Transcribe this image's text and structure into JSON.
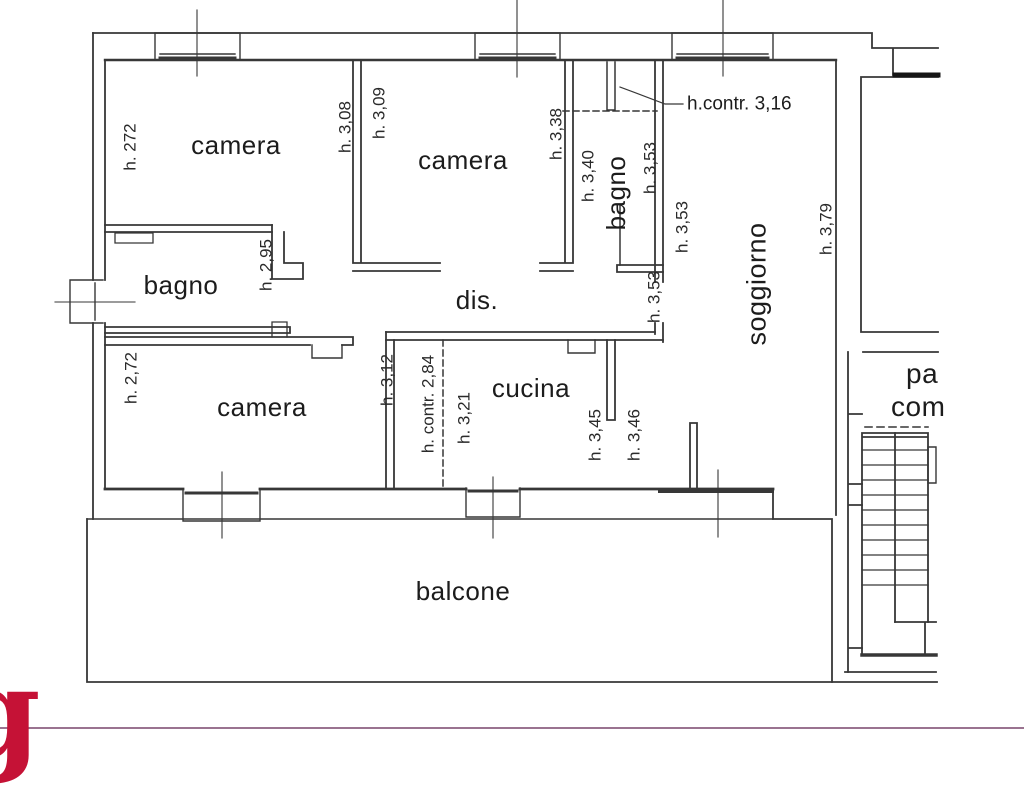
{
  "plan": {
    "rooms": {
      "camera_top_left": "camera",
      "camera_top_mid": "camera",
      "bagno_top": "bagno",
      "soggiorno": "soggiorno",
      "bagno_left": "bagno",
      "disimpegno": "dis.",
      "camera_bottom_left": "camera",
      "cucina": "cucina",
      "balcone": "balcone"
    },
    "common_area": {
      "line1": "pa",
      "line2": "com"
    },
    "heights": {
      "camera_top_left_h": "h. 272",
      "camera_top_left_right_h": "h. 3,08",
      "camera_top_mid_left_h": "h. 3,09",
      "camera_top_mid_right_h": "h. 3,38",
      "bagno_top_left_h": "h. 3,40",
      "bagno_top_right_h": "h. 3,53",
      "soggiorno_upper_left_h": "h. 3,53",
      "soggiorno_lower_left_h": "h. 3,53",
      "soggiorno_right_h": "h. 3,79",
      "ceiling_note_top": "h.contr. 3,16",
      "bagno_left_h": "h. 2,95",
      "camera_bottom_left_h": "h. 2,72",
      "camera_bottom_right_h": "h. 3,12",
      "cucina_ceiling_note": "h. contr. 2,84",
      "cucina_left_h": "h. 3,21",
      "cucina_right_h": "h. 3,45",
      "soggiorno_bottom_h": "h. 3,46"
    },
    "colors": {
      "wall_line": "#373737",
      "footer_line": "#9a7390",
      "logo_red": "#c51236"
    }
  },
  "footer": {
    "logo_glyph": "g"
  }
}
